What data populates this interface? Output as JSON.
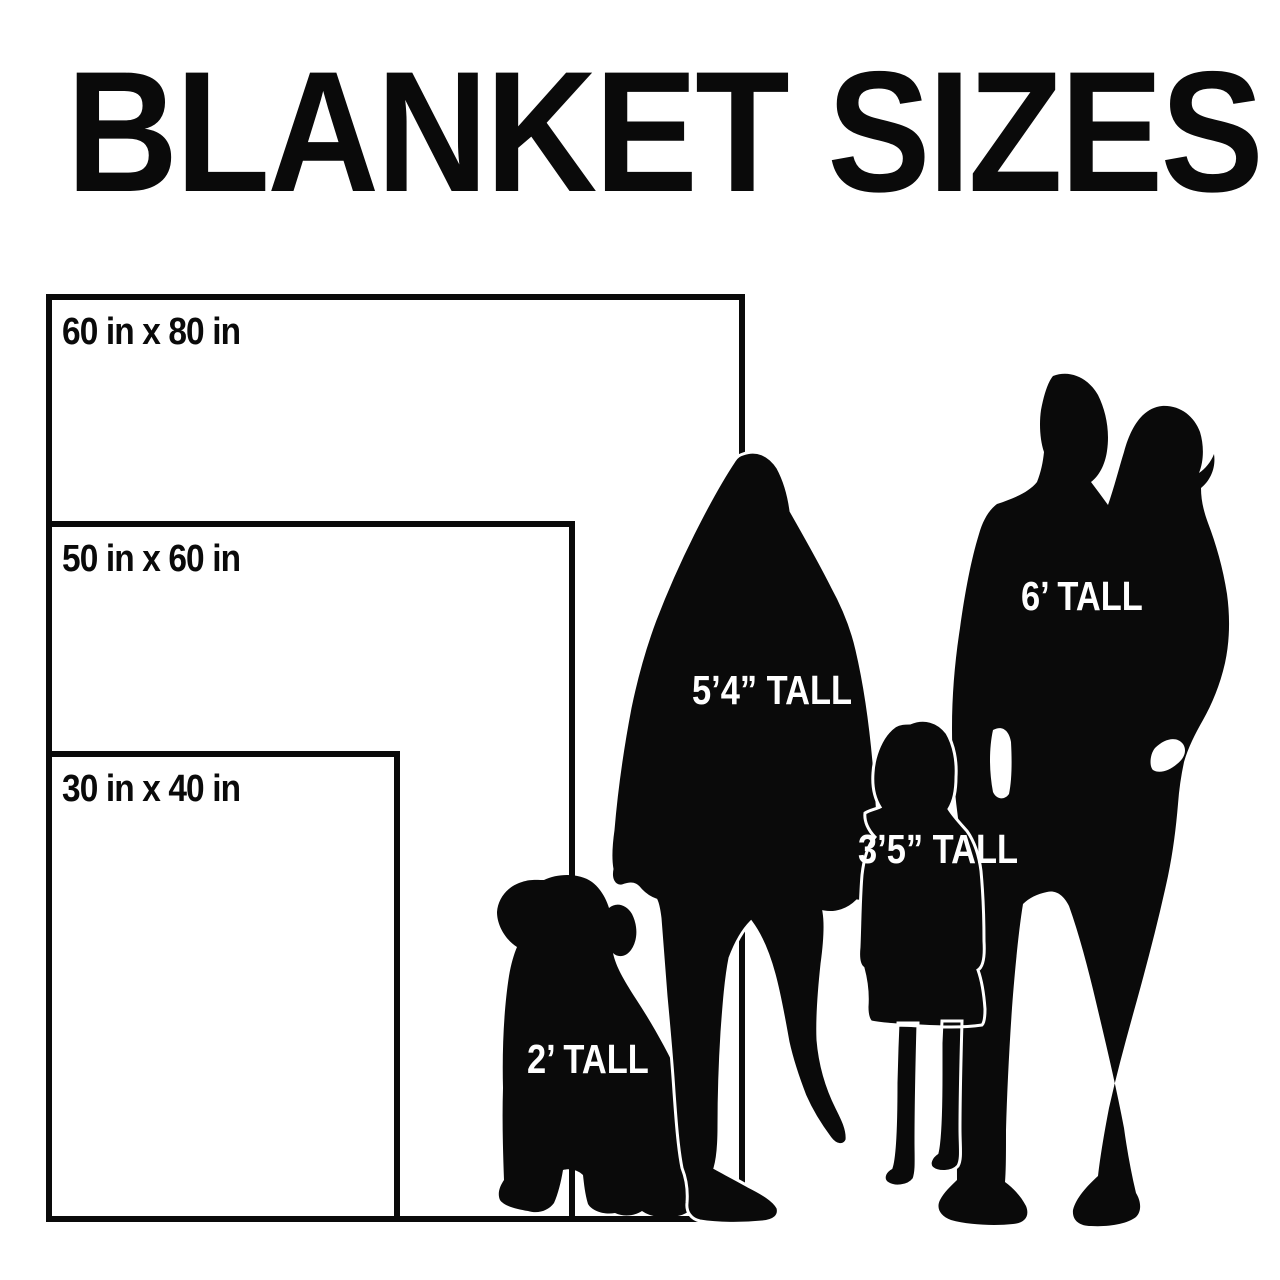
{
  "title": "BLANKET SIZES",
  "colors": {
    "background": "#ffffff",
    "ink": "#0a0a0a",
    "label_on_dark": "#ffffff"
  },
  "blankets": [
    {
      "name": "large",
      "label": "60 in x 80 in",
      "width_in": 60,
      "height_in": 80
    },
    {
      "name": "medium",
      "label": "50 in x 60 in",
      "width_in": 50,
      "height_in": 60
    },
    {
      "name": "small",
      "label": "30 in x 40 in",
      "width_in": 30,
      "height_in": 40
    }
  ],
  "figures": [
    {
      "name": "dog",
      "label": "2’ TALL"
    },
    {
      "name": "woman",
      "label": "5’4” TALL"
    },
    {
      "name": "girl",
      "label": "3’5” TALL"
    },
    {
      "name": "man-with-child",
      "label": "6’ TALL"
    }
  ]
}
